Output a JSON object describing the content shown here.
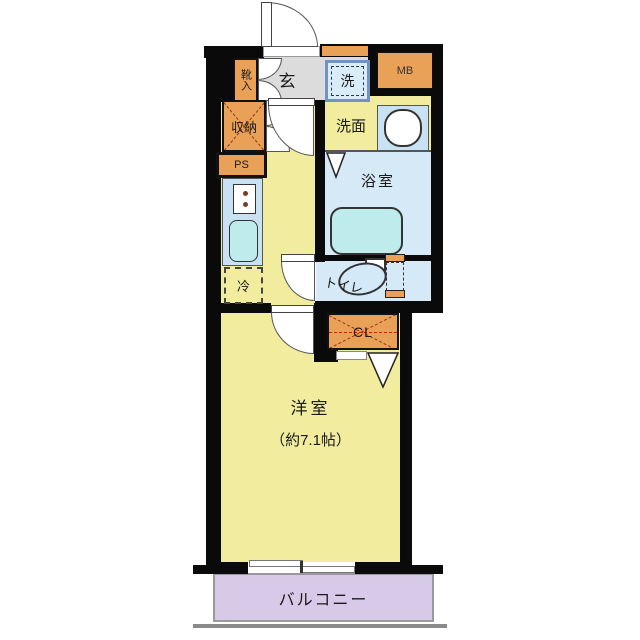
{
  "title": "1K apartment floor plan",
  "labels": {
    "entrance": "玄",
    "shoe_cabinet": "靴入",
    "storage": "収納",
    "pipe_space": "PS",
    "meter_box": "MB",
    "washing_machine": "洗",
    "washroom": "洗面",
    "bathroom": "浴室",
    "refrigerator": "冷",
    "toilet": "トイレ",
    "closet": "CL",
    "main_room": "洋室",
    "main_room_size": "（約7.1帖）",
    "balcony": "バルコニー"
  },
  "colors": {
    "wall": "#0a0a0a",
    "floor_yellow": "#F1EC9E",
    "tile_gray": "#DCDCDC",
    "wet_blue": "#D6E9F7",
    "panel_blue": "#C9E2F3",
    "fixture_cyan": "#BEEBEB",
    "cabinet_orange": "#E8A156",
    "balcony_lavender": "#D6CAE8",
    "dash_red": "#993322",
    "washer_frame": "#6F94C2"
  }
}
